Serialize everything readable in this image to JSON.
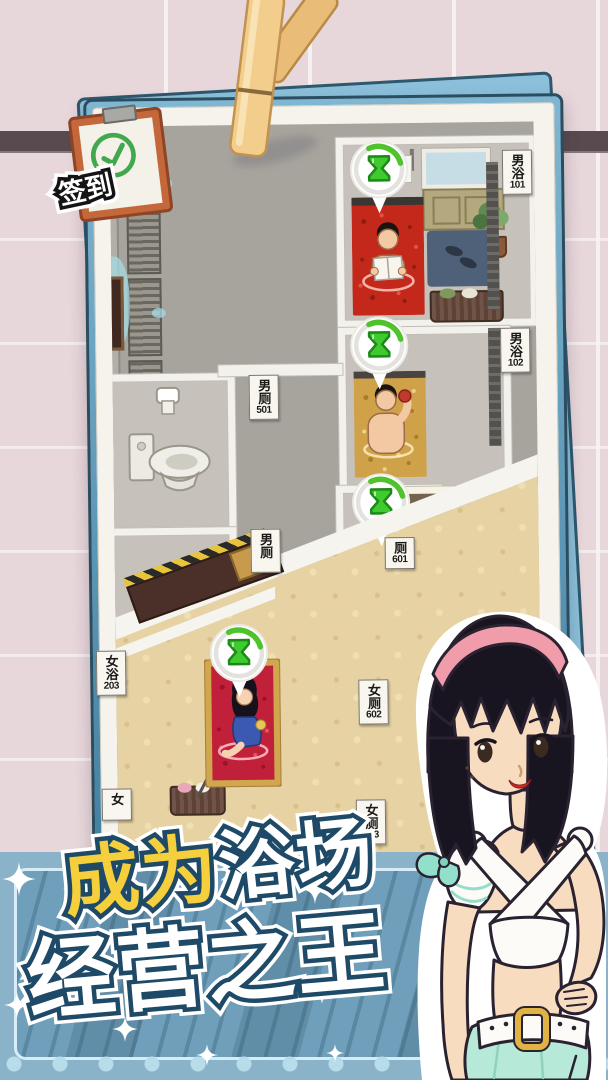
{
  "stamp": {
    "label": "签到",
    "check_icon": "✓"
  },
  "signs": [
    {
      "chars": "男浴",
      "num": "101"
    },
    {
      "chars": "男浴",
      "num": "102"
    },
    {
      "chars": "男厕",
      "num": "501"
    },
    {
      "chars": "男厕",
      "num": ""
    },
    {
      "chars": "厕",
      "num": "601"
    },
    {
      "chars": "女浴",
      "num": "203"
    },
    {
      "chars": "女厕",
      "num": "602"
    },
    {
      "chars": "女",
      "num": ""
    },
    {
      "chars": "女厕",
      "num": "603"
    }
  ],
  "banner": {
    "line1_yellow": "成为",
    "line1_white": "浴场",
    "line2": "经营之王"
  },
  "colors": {
    "accent_green": "#3fca2f",
    "banner_blue": "#6f9fba",
    "banner_navy": "#1e4a68",
    "title_yellow": "#f6d03c",
    "mens_grey": "#a7a39d",
    "womens_gold": "#e6d2a2",
    "tub_red": "#c1203a",
    "tub_yellow": "#cfa148"
  }
}
